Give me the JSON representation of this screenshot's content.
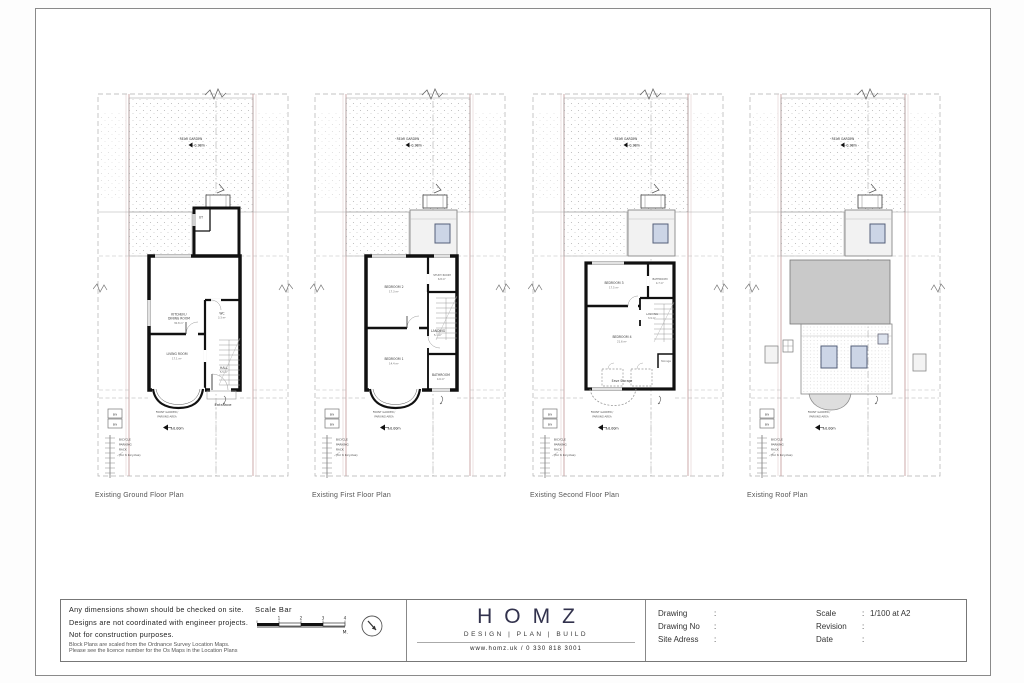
{
  "site": {
    "rear_garden": "REAR GARDEN",
    "rear_garden_level": "-0.38m",
    "front_garden_line1": "FRONT GARDEN /",
    "front_garden_line2": "PARKING-AREA",
    "front_garden_level": "±0.00m",
    "bin": "BIN",
    "bicycle_line1": "BICYCLE",
    "bicycle_line2": "PARKING",
    "bicycle_line3": "RACK",
    "bicycle_line4": "(for 6 bicycles)",
    "entrance": "Entrance"
  },
  "plans": [
    {
      "title": "Existing Ground Floor Plan",
      "rooms": {
        "ut": {
          "name": "UT"
        },
        "kitchen": {
          "line1": "KITCHEN /",
          "line2": "DINING ROOM",
          "area": "30.8 m²"
        },
        "wc": {
          "name": "WC",
          "area": "3.3 m²"
        },
        "living": {
          "name": "LIVING ROOM",
          "area": "17.1 m²"
        },
        "hall": {
          "name": "HALL",
          "area": "5.5 m²"
        }
      }
    },
    {
      "title": "Existing First Floor Plan",
      "rooms": {
        "bedroom2": {
          "name": "BEDROOM 2",
          "area": "17.3 m²"
        },
        "study": {
          "name": "STUDY ROOM",
          "area": "6.8 m²"
        },
        "landing": {
          "name": "LANDING",
          "area": "5.1 m²"
        },
        "bedroom1": {
          "name": "BEDROOM 1",
          "area": "14.4 m²"
        },
        "bathroom": {
          "name": "BATHROOM",
          "area": "4.6 m²"
        }
      }
    },
    {
      "title": "Existing Second Floor Plan",
      "rooms": {
        "bedroom3": {
          "name": "BEDROOM 3",
          "area": "17.5 m²"
        },
        "bathroom": {
          "name": "BATHROOM",
          "area": "4.7 m²"
        },
        "landing": {
          "name": "LANDING",
          "area": "3.9 m²"
        },
        "bedroom4": {
          "name": "BEDROOM 4",
          "area": "21.6 m²"
        },
        "storage": {
          "name": "Storage"
        },
        "eave_storage": {
          "name": "Eave Storage"
        }
      }
    },
    {
      "title": "Existing Roof Plan",
      "rooms": {}
    }
  ],
  "title_block": {
    "notes": [
      "Any dimensions shown should be checked on site.",
      "Designs are not coordinated with engineer projects.",
      "Not for construction purposes."
    ],
    "small_print": [
      "Block Plans are scaled from the Ordnance Survey Location Maps.",
      "Please see the licence number for the Os Maps in the Location Plans"
    ],
    "scale_bar": {
      "label": "Scale Bar",
      "ticks": [
        "1",
        "2",
        "3",
        "4"
      ],
      "unit": "M."
    },
    "logo": {
      "name": "HOMZ",
      "tagline": "DESIGN | PLAN | BUILD",
      "contact": "www.homz.uk / 0 330 818 3001"
    },
    "sep": ":",
    "fields_left": [
      {
        "label": "Drawing",
        "value": ""
      },
      {
        "label": "Drawing No",
        "value": ""
      },
      {
        "label": "Site Adress",
        "value": ""
      }
    ],
    "fields_right": [
      {
        "label": "Scale",
        "value": "1/100 at A2"
      },
      {
        "label": "Revision",
        "value": ""
      },
      {
        "label": "Date",
        "value": ""
      }
    ]
  },
  "colors": {
    "logo_navy": "#32324d",
    "boundary_pink": "#c9a2a2",
    "flat_roof_gray": "#c9c9c9",
    "roof_window_blue": "#ccd5e6",
    "wall_black": "#111111"
  }
}
